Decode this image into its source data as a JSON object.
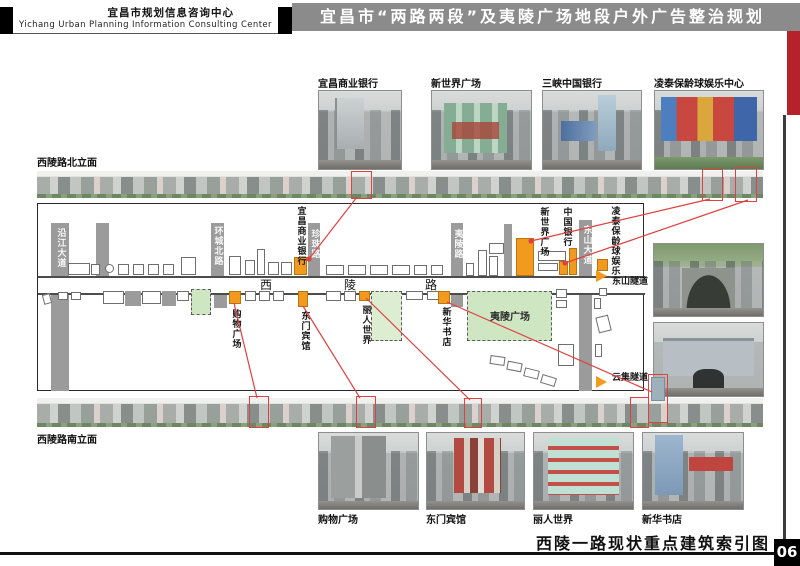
{
  "header": {
    "org_cn": "宜昌市规划信息咨询中心",
    "org_en": "Yichang Urban Planning Information Consulting Center",
    "title": "宜昌市“两路两段”及夷陵广场地段户外广告整治规划"
  },
  "colors": {
    "header_gray": "#8b8b8b",
    "accent_red": "#b5222a",
    "highlight_orange": "#f29a1d",
    "map_green": "#cfe6c2",
    "road_gray": "#9b9b9b",
    "index_line_red": "#e04040"
  },
  "top_photos": [
    {
      "label": "宜昌商业银行"
    },
    {
      "label": "新世界广场"
    },
    {
      "label": "三峡中国银行"
    },
    {
      "label": "凌泰保龄球娱乐中心"
    }
  ],
  "elevations": {
    "north": "西陵路北立面",
    "south": "西陵路南立面"
  },
  "map": {
    "roads": {
      "yanjiang": "沿江大道",
      "huancheng": "环城北路",
      "zhenzhu": "珍珠路",
      "yiling_road": "夷陵路",
      "dongshan": "东山大道",
      "xiling": [
        "西",
        "陵",
        "路"
      ]
    },
    "north_landmarks": {
      "bank": "宜昌商业银行",
      "new_world": "新世界广场",
      "china_bank": "中国银行",
      "lingtai": "凌泰保龄球娱乐"
    },
    "south_landmarks": {
      "shopping": "购物广场",
      "dongmen": "东门宾馆",
      "liren": "丽人世界",
      "xinhua": "新华书店"
    },
    "plaza": "夷陵广场",
    "tunnels": {
      "dongshan_tunnel": "东山隧道",
      "yunji_tunnel": "云集隧道"
    }
  },
  "bottom_photos": [
    {
      "label": "购物广场"
    },
    {
      "label": "东门宾馆"
    },
    {
      "label": "丽人世界"
    },
    {
      "label": "新华书店"
    }
  ],
  "footer": {
    "caption": "西陵一路现状重点建筑索引图",
    "page_no": "06"
  }
}
